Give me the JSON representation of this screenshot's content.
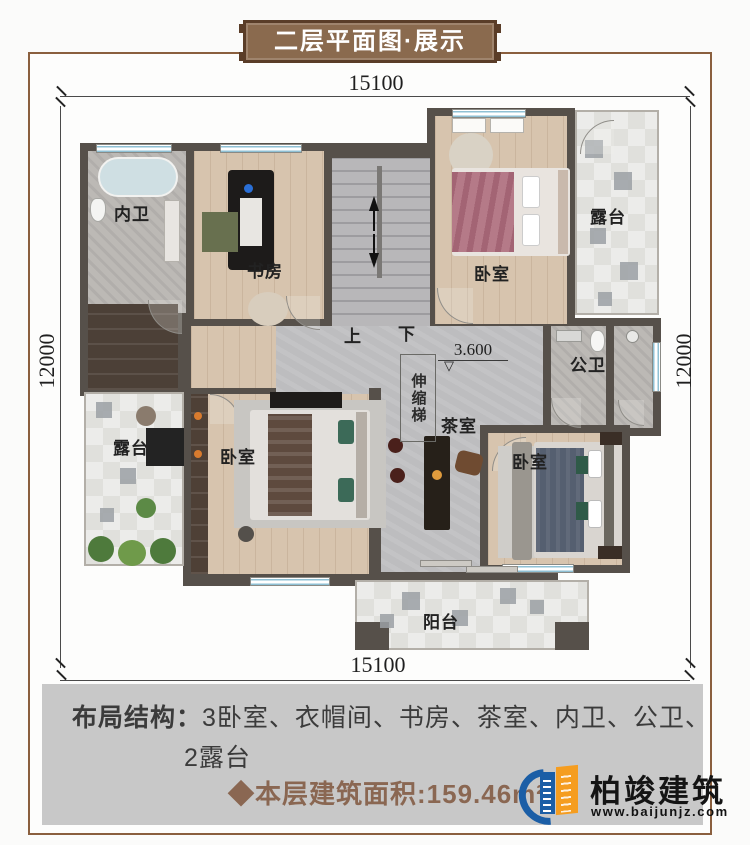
{
  "title_banner": {
    "text": "二层平面图·展示"
  },
  "dimensions": {
    "top": "15100",
    "bottom": "15100",
    "left": "12000",
    "right": "12000",
    "elevation": "3.600"
  },
  "rooms": {
    "neiwei": "内卫",
    "shufang": "书房",
    "bedroom_top": "卧室",
    "terrace_right": "露台",
    "gongwei": "公卫",
    "terrace_left": "露台",
    "bedroom_left": "卧室",
    "teahouse": "茶室",
    "bedroom_bottom": "卧室",
    "balcony": "阳台",
    "ladder": "伸缩梯",
    "stairs_up": "上",
    "stairs_down": "下",
    "elevation_mark": "▽"
  },
  "footer": {
    "layout_label": "布局结构：",
    "layout_line1": "3卧室、衣帽间、书房、茶室、内卫、公卫、",
    "layout_line2": "2露台",
    "area_text": "◆本层建筑面积:159.46m²"
  },
  "logo": {
    "name": "柏竣建筑",
    "website": "www.baijunjz.com"
  },
  "colors": {
    "wall": "#56504a",
    "banner_brown": "#8a6a4e",
    "frame_brown": "#8a5f3e",
    "footer_bg": "#c8c8c8",
    "area_text": "#8a6752",
    "logo_blue": "#1b5ea6",
    "logo_orange": "#f59d20",
    "window_blue": "#8fc0d4"
  }
}
